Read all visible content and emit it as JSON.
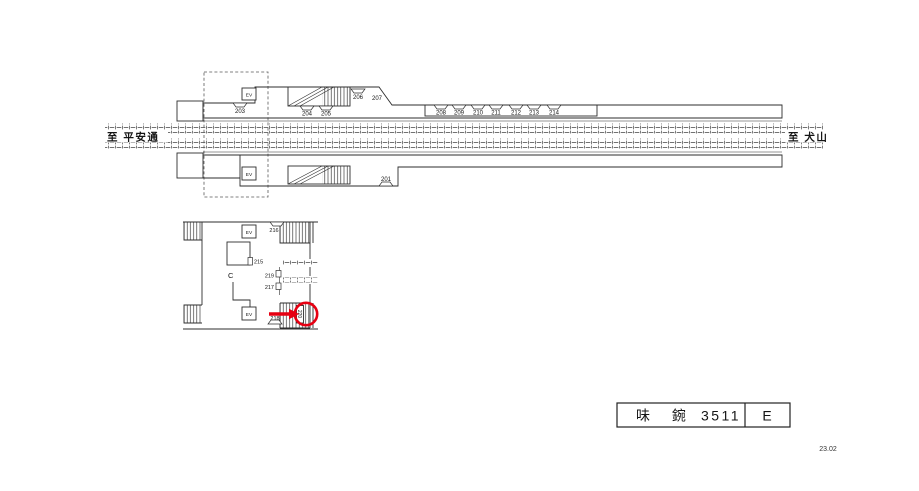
{
  "title_block": {
    "station_name": "味 鋺",
    "map_code": "3511",
    "size_class": "E"
  },
  "footer": {
    "date_code": "23.02"
  },
  "directions": {
    "left": "至 平安通",
    "right": "至 犬山"
  },
  "upper_platform": {
    "ev_label": "EV",
    "signs": {
      "s203": "203",
      "s204": "204",
      "s205": "205",
      "s206": "206",
      "s207": "207",
      "s208": "208",
      "s209": "209",
      "s210": "210",
      "s211": "211",
      "s212": "212",
      "s213": "213",
      "s214": "214"
    }
  },
  "lower_platform": {
    "ev_label": "EV",
    "signs": {
      "s201": "201"
    }
  },
  "concourse": {
    "ev_upper_label": "EV",
    "ev_lower_label": "EV",
    "point_label": "C",
    "signs": {
      "s215": "215",
      "s216": "216",
      "s217": "217",
      "s218": "218",
      "s219": "219"
    },
    "highlighted_sign": "220"
  }
}
